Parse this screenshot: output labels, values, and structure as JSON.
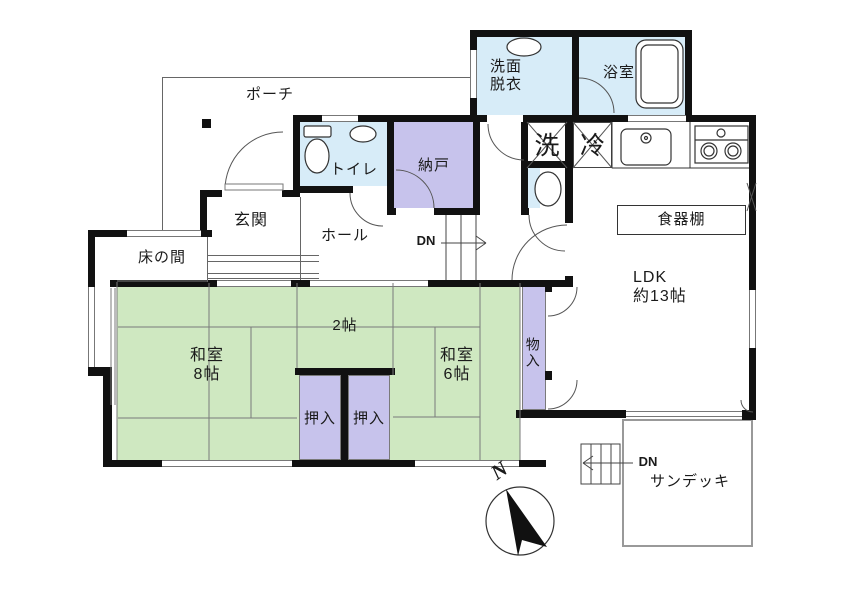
{
  "title": "floor-plan",
  "colors": {
    "tatami_green": "#cfe8c1",
    "closet_purple": "#c7c3ec",
    "water_blue": "#d7ecf8",
    "wall_black": "#111111",
    "line_gray": "#666666"
  },
  "rooms": {
    "porch": {
      "label": "ポーチ"
    },
    "washroom": {
      "label": "洗面\n脱衣"
    },
    "bathroom": {
      "label": "浴室"
    },
    "toilet": {
      "label": "トイレ"
    },
    "nando": {
      "label": "納戸"
    },
    "genkan": {
      "label": "玄関"
    },
    "hall": {
      "label": "ホール"
    },
    "tokonoma": {
      "label": "床の間"
    },
    "washitsu8": {
      "label": "和室\n8帖"
    },
    "two_jo": {
      "label": "2帖"
    },
    "washitsu6": {
      "label": "和室\n6帖"
    },
    "oshiire_left": {
      "label": "押入"
    },
    "oshiire_right": {
      "label": "押入"
    },
    "monoire": {
      "label": "物入"
    },
    "ldk": {
      "label": "LDK\n約13帖"
    },
    "cupboard": {
      "label": "食器棚"
    },
    "sundeck": {
      "label": "サンデッキ"
    }
  },
  "appliances": {
    "washer": "洗",
    "fridge": "冷"
  },
  "stairs": {
    "hall_dn": "DN",
    "deck_dn": "DN"
  },
  "compass": {
    "north": "N"
  }
}
